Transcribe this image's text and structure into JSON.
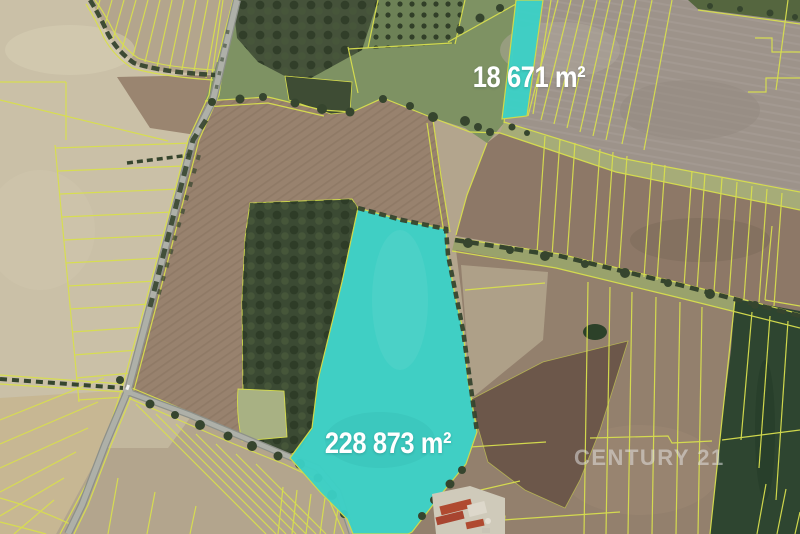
{
  "map": {
    "type": "aerial-cadastral-photo",
    "parcels": [
      {
        "name": "highlighted-parcel-small",
        "area_label": "18 671 m²"
      },
      {
        "name": "highlighted-parcel-large",
        "area_label": "228 873 m²"
      }
    ],
    "watermark": {
      "brand": "CENTURY 21"
    },
    "colors": {
      "parcel_highlight": "#3bd0c6",
      "cadastral_line": "#d8df4e",
      "road": "#aeb0a8",
      "forest_green": "#3b4a33",
      "crop_green": "#2e4530",
      "field_pale": "#cac0a7",
      "field_brown": "#98826e",
      "label_text": "#ffffff",
      "watermark_text": "#e4e4e4"
    }
  }
}
